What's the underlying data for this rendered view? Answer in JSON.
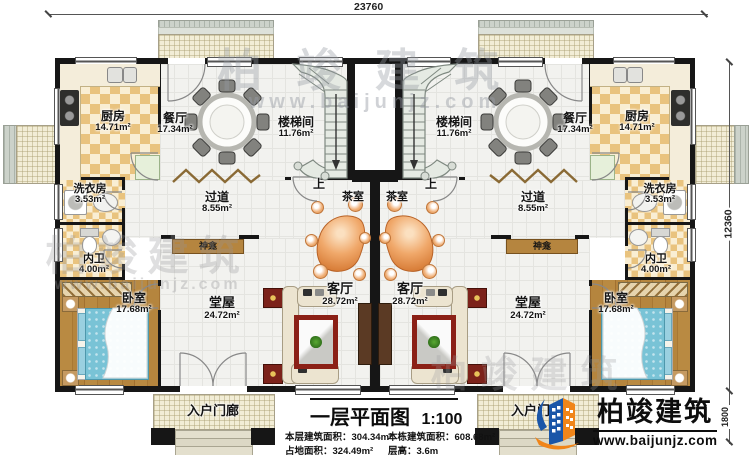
{
  "dimensions": {
    "top_width": "23760",
    "right_height": "12360",
    "right_porch": "1800"
  },
  "rooms": {
    "kitchen": {
      "name": "厨房",
      "area": "14.71m²"
    },
    "dining": {
      "name": "餐厅",
      "area": "17.34m²"
    },
    "stairwell": {
      "name": "楼梯间",
      "area": "11.76m²"
    },
    "laundry": {
      "name": "洗衣房",
      "area": "3.53m²"
    },
    "toilet": {
      "name": "内卫",
      "area": "4.00m²"
    },
    "hallway": {
      "name": "过道",
      "area": "8.55m²"
    },
    "bedroom": {
      "name": "卧室",
      "area": "17.68m²"
    },
    "hall": {
      "name": "堂屋",
      "area": "24.72m²"
    },
    "living": {
      "name": "客厅",
      "area": "28.72m²"
    },
    "tea_room": {
      "name": "茶室"
    },
    "shrine": {
      "name": "神龛"
    },
    "porch": {
      "name": "入户门廊"
    },
    "stairs_up": "上"
  },
  "title_block": {
    "title": "一层平面图",
    "scale": "1:100",
    "stats": [
      {
        "label": "本层建筑面积：",
        "value": "304.34m²"
      },
      {
        "label": "本栋建筑面积：",
        "value": "608.68m²"
      },
      {
        "label": "占地面积：",
        "value": "324.49m²"
      },
      {
        "label": "层高：",
        "value": "3.6m"
      }
    ]
  },
  "brand": {
    "name": "柏竣建筑",
    "website": "www.baijunjz.com"
  },
  "watermark": {
    "name": "柏竣建筑",
    "website": "www.baijunjz.com"
  },
  "colors": {
    "wall": "#161616",
    "kitchen_tile": "#e9c37e",
    "wood_floor": "#b5853e",
    "bed": "#79c3d6",
    "sofa": "#ece4d0",
    "rug": "#8b2016",
    "tea_table": "#e08a4a",
    "terrace": "#f2edd6",
    "brand_blue": "#1a56a8",
    "brand_orange": "#f08519"
  }
}
